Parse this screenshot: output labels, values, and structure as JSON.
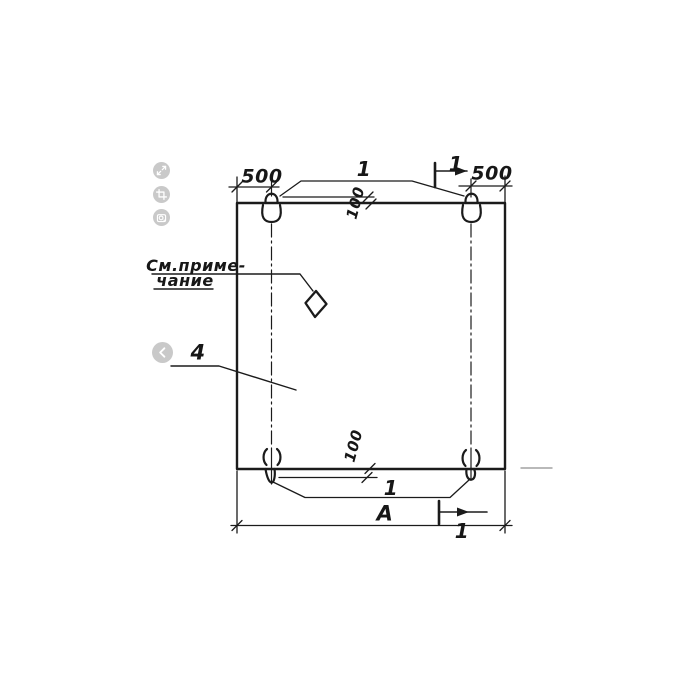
{
  "colors": {
    "ink": "#1b1b1b",
    "faint_line": "#8f8f8f",
    "button_bg": "#c9c9c9",
    "button_glyph": "#ffffff",
    "background": "#ffffff"
  },
  "viewer": {
    "buttons": [
      {
        "name": "expand-button",
        "icon": "expand-icon"
      },
      {
        "name": "crop-button",
        "icon": "crop-icon"
      },
      {
        "name": "lens-button",
        "icon": "lens-icon"
      },
      {
        "name": "previous-button",
        "icon": "chevron-left-icon"
      }
    ]
  },
  "drawing": {
    "dimensions": {
      "left_offset": "500",
      "right_offset": "500",
      "loop_inset_top": "100",
      "loop_inset_bottom": "100",
      "width": "А"
    },
    "references": {
      "loops_top": "1",
      "loops_bottom": "1",
      "panel": "4"
    },
    "sections": {
      "top": "1",
      "bottom": "1"
    },
    "note": {
      "line1": "См.приме-",
      "line2": "чание"
    }
  }
}
